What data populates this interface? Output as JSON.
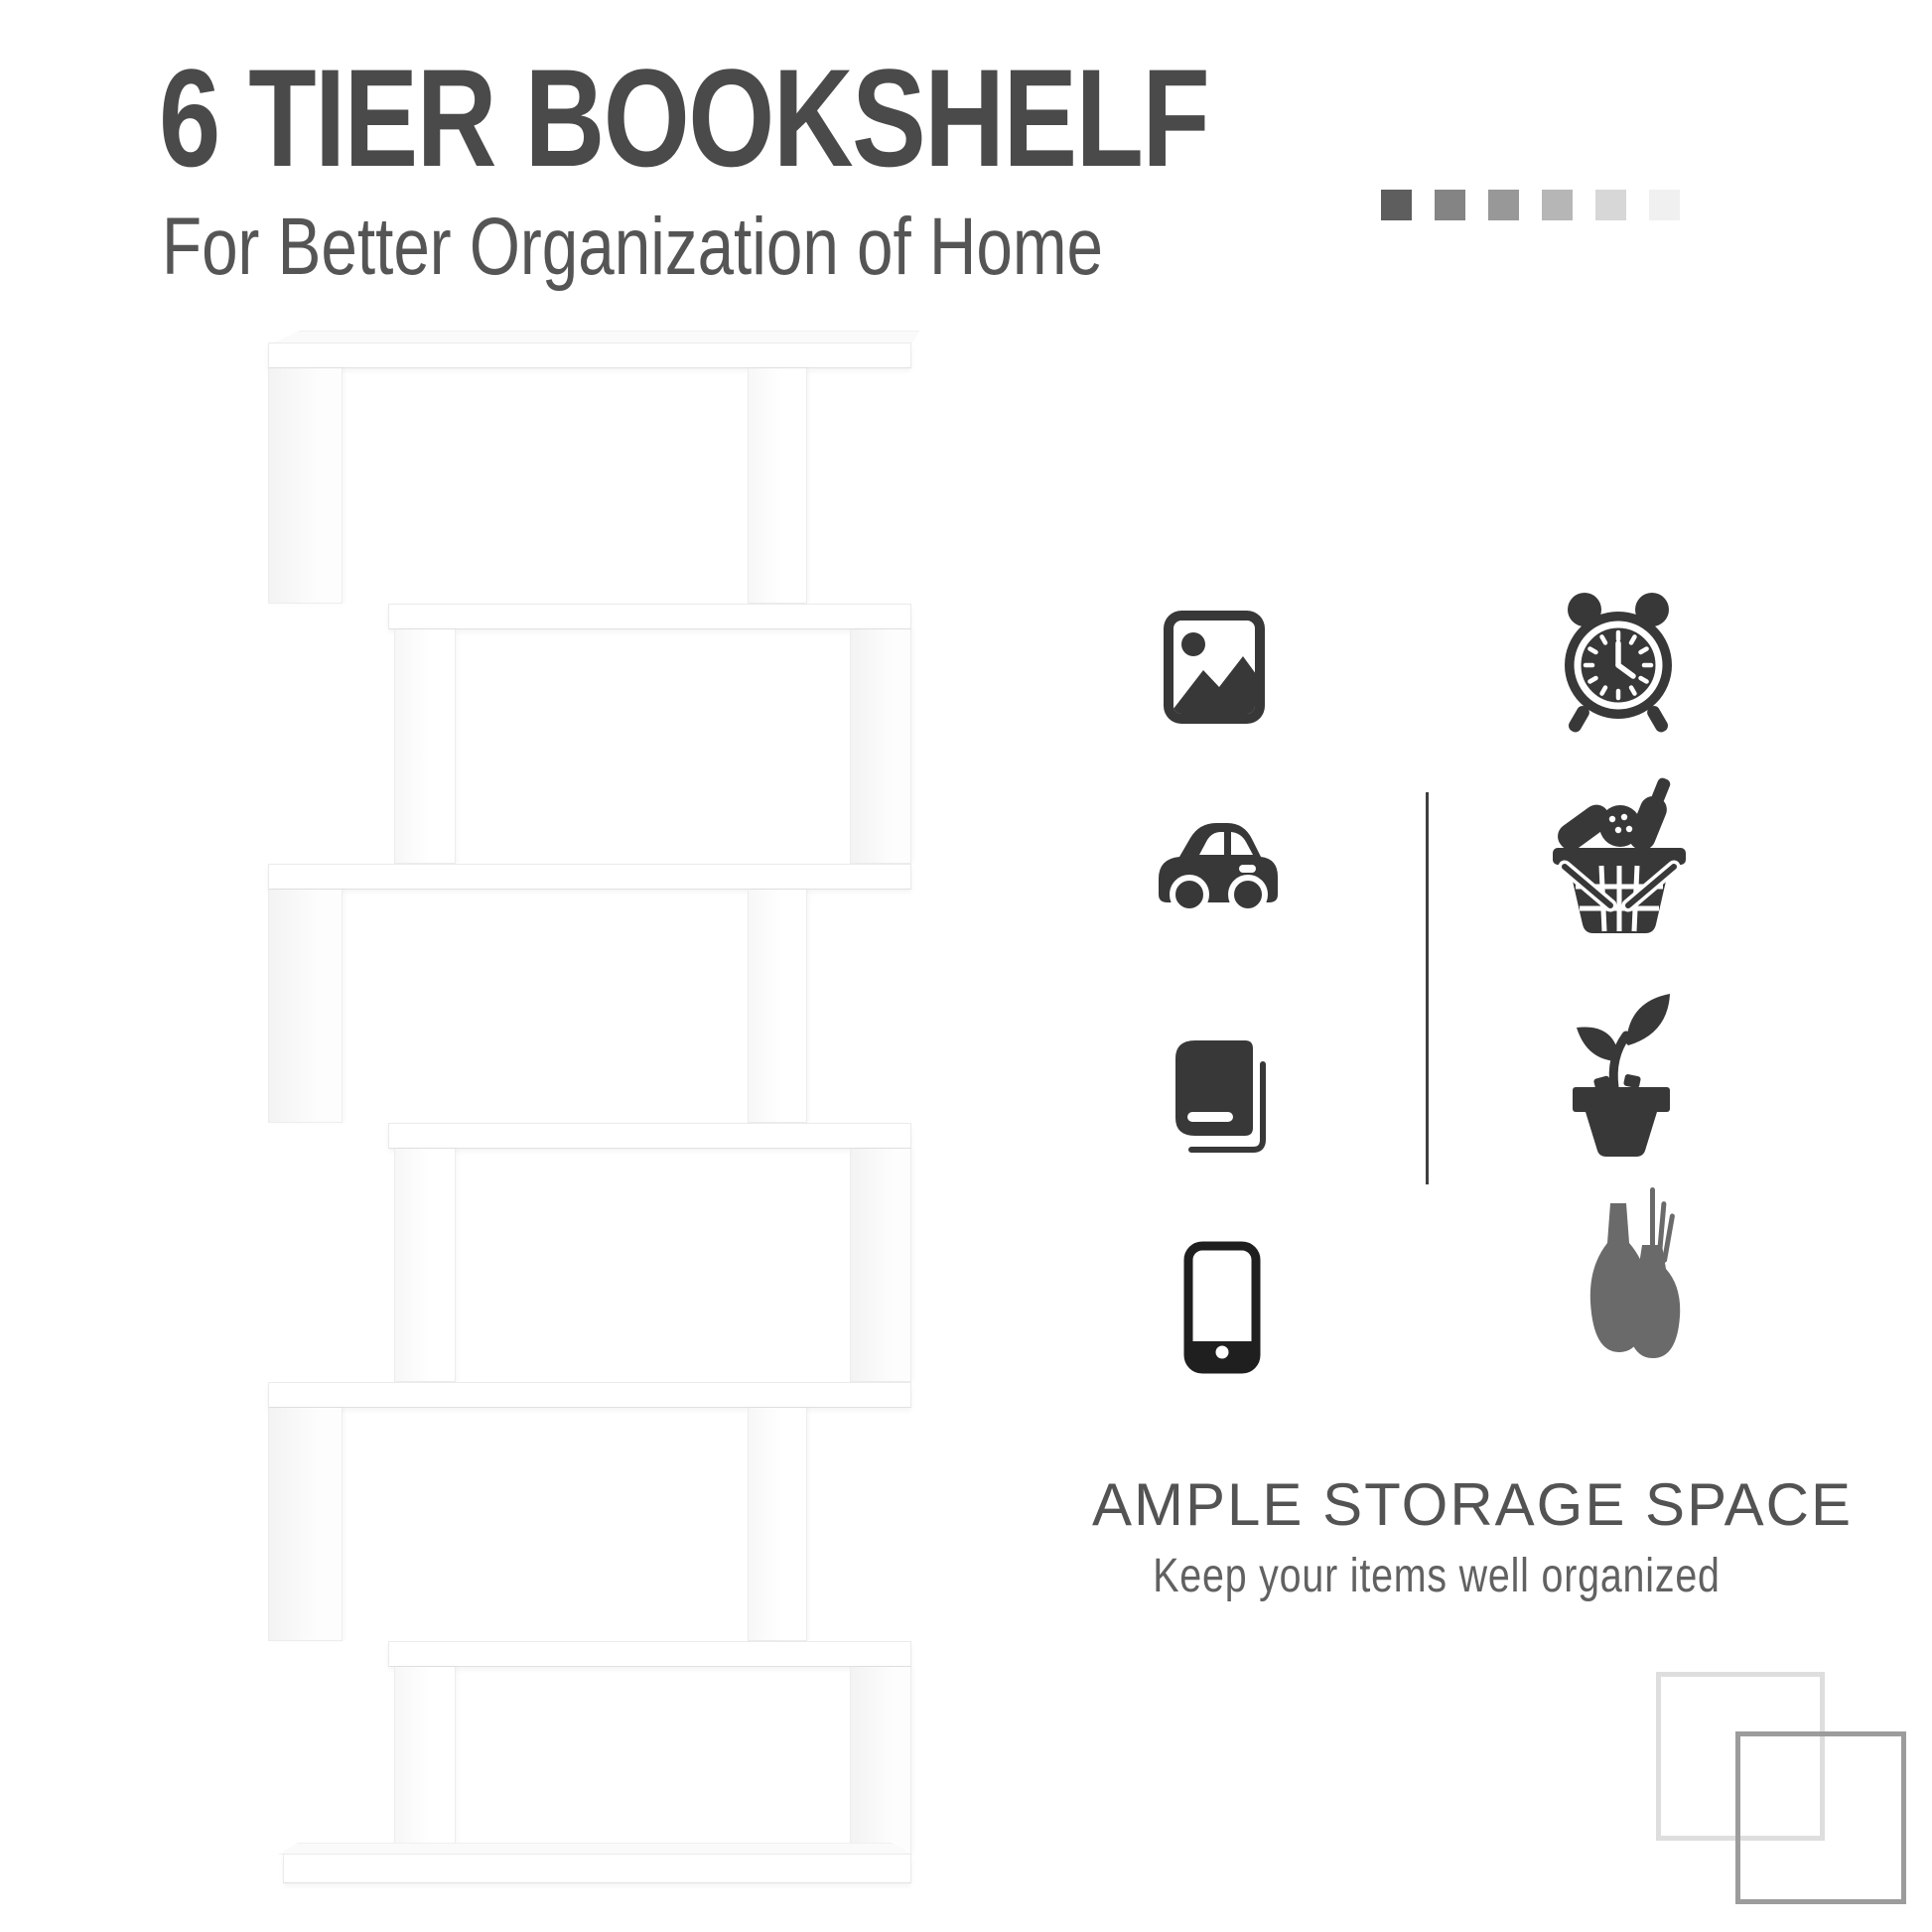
{
  "header": {
    "title": "6 TIER BOOKSHELF",
    "subtitle": "For Better Organization of Home",
    "squares": [
      "#5e5e5e",
      "#848484",
      "#989898",
      "#b6b6b6",
      "#d7d7d7",
      "#f0f0f0"
    ]
  },
  "features": {
    "left_icons": [
      "picture-icon",
      "car-icon",
      "book-icon",
      "smartphone-icon"
    ],
    "right_icons": [
      "alarm-clock-icon",
      "shopping-basket-icon",
      "potted-plant-icon",
      "vases-icon"
    ]
  },
  "storage": {
    "heading": "AMPLE STORAGE SPACE",
    "subheading": "Keep your items well organized"
  },
  "decor": {
    "outline_squares": [
      "#dedede",
      "#9c9c9c"
    ]
  },
  "colors": {
    "title": "#4a4a4a",
    "subtitle": "#555555",
    "heading": "#535353",
    "subheading": "#616161",
    "icon": "#383838",
    "icon_dark": "#1f1f1f",
    "vase_icon": "#6a6a6a",
    "divider": "#3f3f3f"
  }
}
